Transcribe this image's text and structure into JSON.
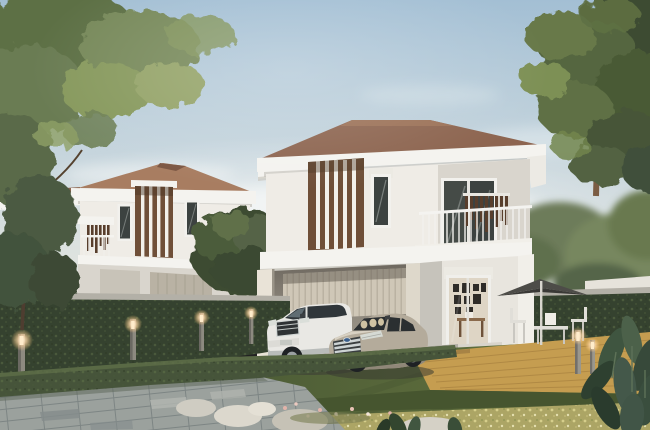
{
  "meta": {
    "description": "3D architectural rendering of two modern two-storey detached houses with brown hipped roofs, white facades and vertical timber slat screens, seen across a clipped green hedge fence with lit bollard lamps; a white SUV and a champagne sedan are parked under the carport of the foreground house; stone-tiled driveway, lawn, golden timber deck with parasol dining set, and tropical planting frame the scene"
  },
  "scene": {
    "objects": [
      "sky-with-soft-clouds",
      "overhanging-tree-top-left",
      "large-tree-right",
      "background-house-left",
      "foreground-house-right",
      "timber-slat-facade-screens",
      "balcony-with-white-railing",
      "carport",
      "white-suv",
      "champagne-sedan",
      "entrance-sliding-glass-door-with-picture-wall",
      "tall-hedge-fence-with-concrete-cap",
      "low-clipped-hedge",
      "bollard-garden-lights",
      "stone-tile-driveway",
      "lawn",
      "timber-deck",
      "parasol-with-outdoor-dining-set",
      "rocks-and-flower-bed",
      "tropical-foliage-plants"
    ],
    "bollard_light_count": 6,
    "car_count": 2,
    "house_count": 2
  },
  "palette": {
    "sky_top": "#a3bfd4",
    "sky_mid": "#c6d5dd",
    "sky_low": "#dde2df",
    "sky_horizon": "#e8e6e0",
    "cloud_white": "#f7f9f8",
    "roof_brown": "#8d6550",
    "roof_brown_light": "#a87d61",
    "fascia_white": "#f4f3ef",
    "wall_white": "#efece6",
    "wall_shade": "#d9d5cd",
    "wall_dark": "#c6c3bb",
    "cream_column": "#e9e3d7",
    "garage_door": "#cfc7b7",
    "slat_brown": "#6f4f38",
    "slat_dark": "#583e2c",
    "glass_dark": "#3c4240",
    "interior_wall": "#ded5c5",
    "frame_dark": "#2e2b27",
    "hedge_dark": "#35422f",
    "hedge_mid": "#46543a",
    "hedge_cap": "#b3b0a7",
    "lawn_dark": "#4c5c36",
    "lawn_light": "#939e50",
    "groundcover": "#aca565",
    "deck_wood": "#c59d50",
    "deck_line": "#a57f3e",
    "pave_base": "#9ba19d",
    "pave_dark": "#848c8c",
    "pave_light": "#b3b7b1",
    "suv_white": "#e9e8e4",
    "sedan_body": "#b4ab9b",
    "tire_dark": "#1e2124",
    "chrome": "#cdd3d4",
    "badge_blue": "#3a5e8c",
    "light_glow": "#ffd9a8",
    "light_post": "#8d8a80",
    "umbrella_gray": "#4d4c48",
    "furniture_white": "#e0ded8",
    "tree_green": "#5d6f45",
    "tree_green_light": "#87995d",
    "tree_green_dark": "#3e4c31",
    "trunk_brown": "#7b5c43",
    "rock_gray": "#cfccc2",
    "flower_pink": "#e2b4aa"
  }
}
